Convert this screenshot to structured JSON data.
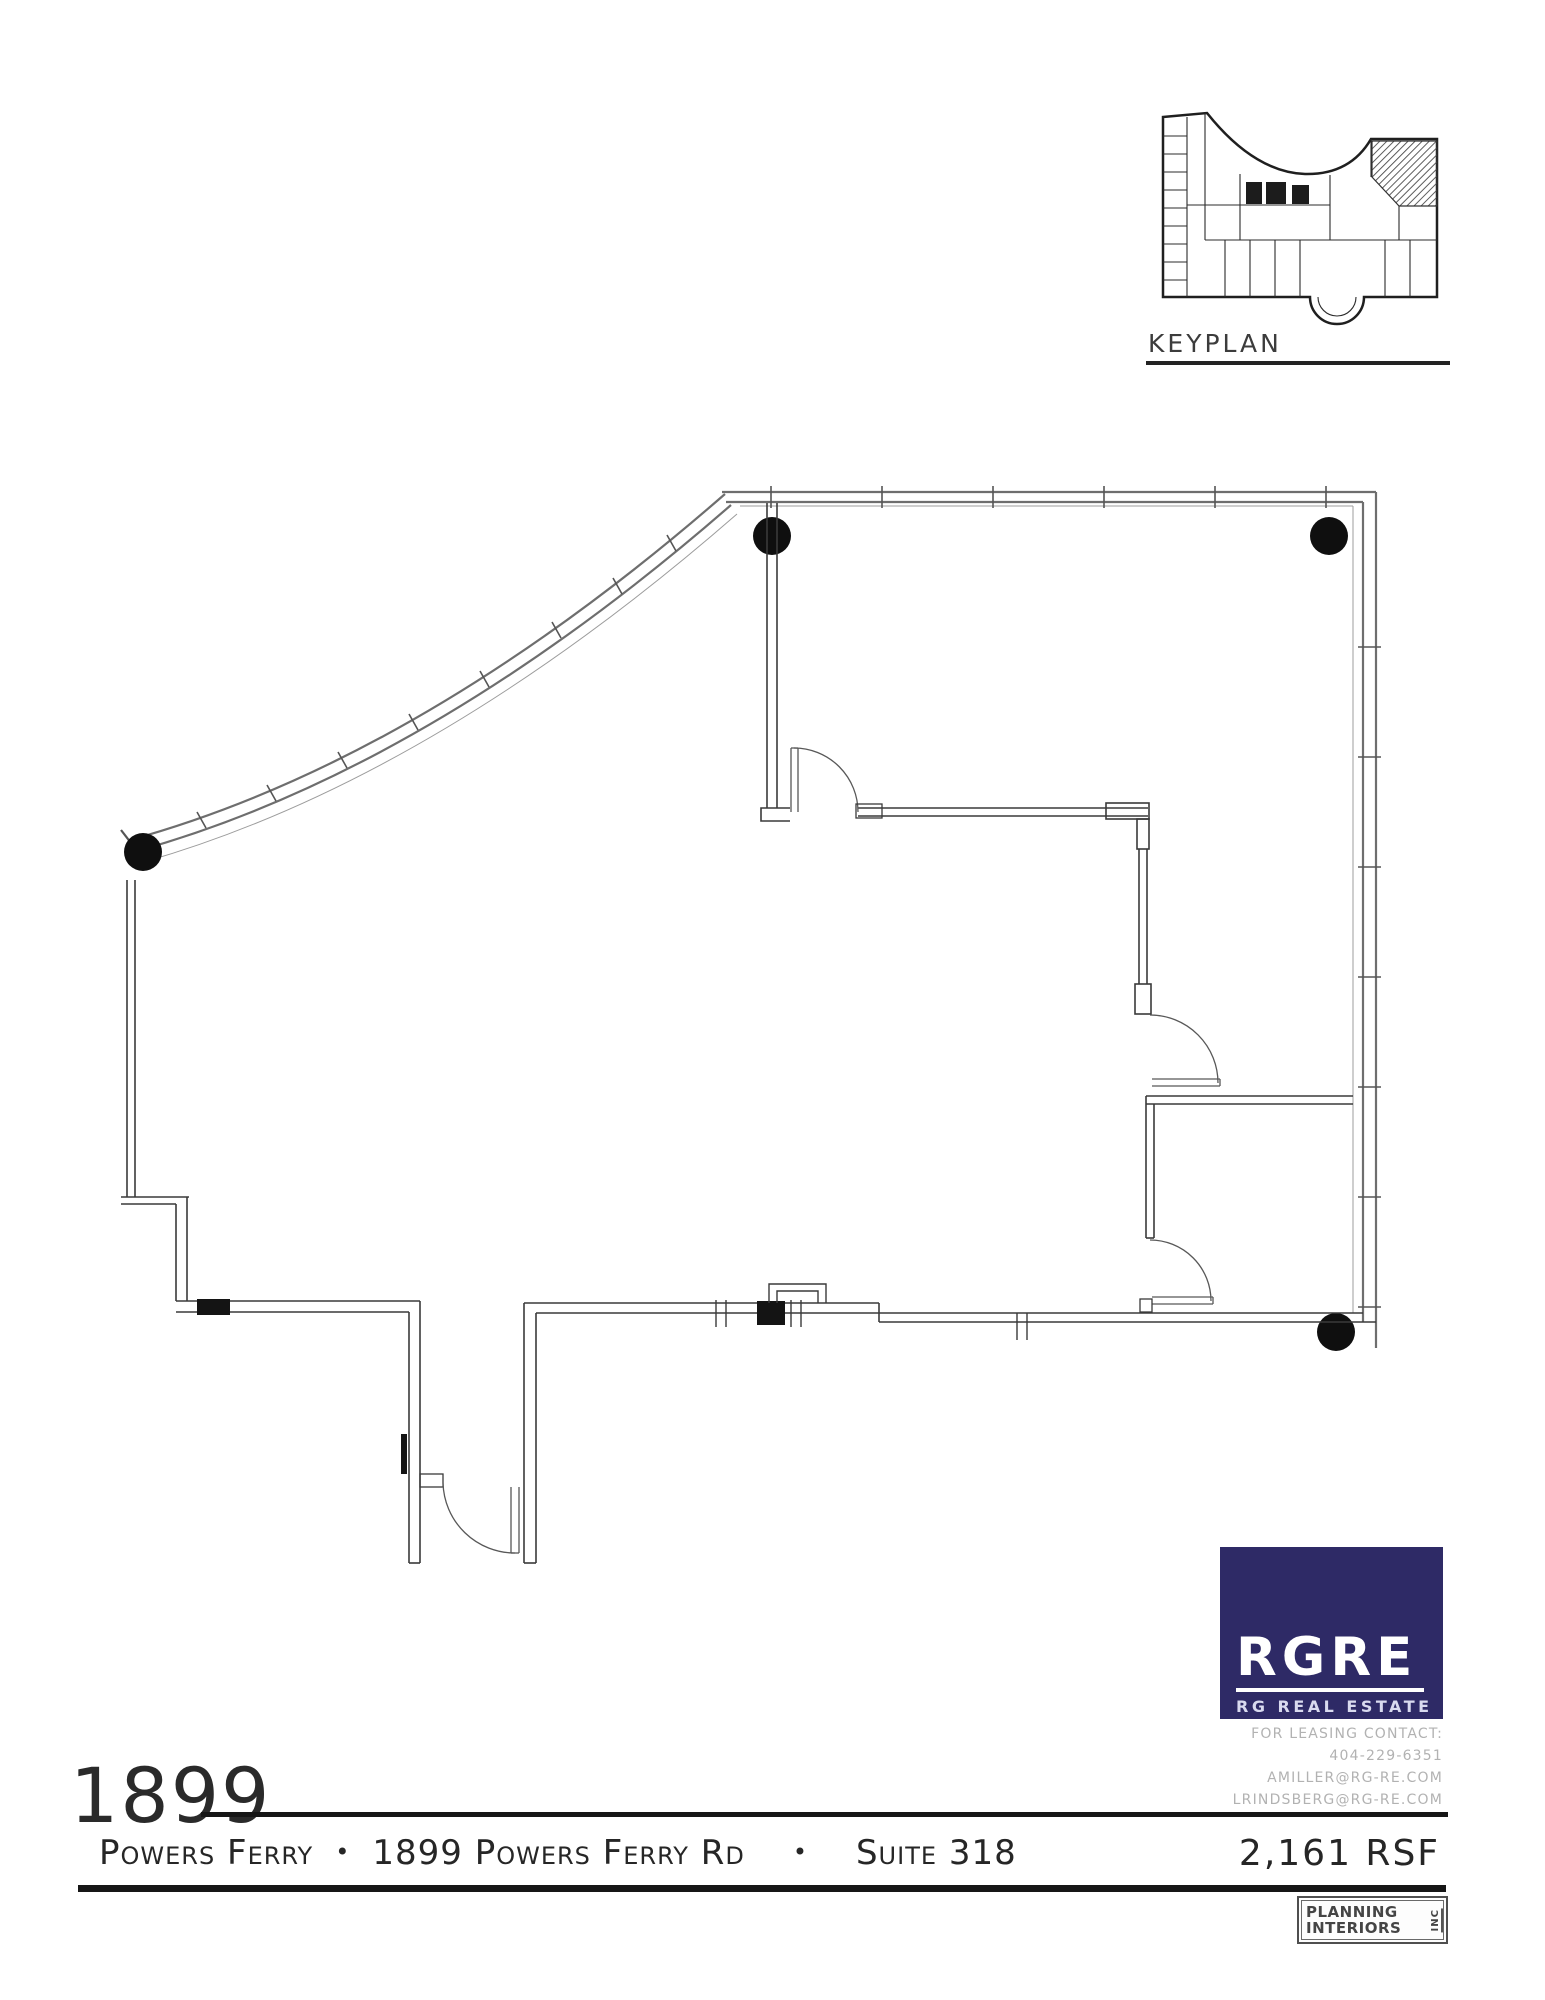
{
  "keyplan": {
    "label": "KEYPLAN"
  },
  "logo": {
    "brand": "RGRE",
    "tagline": "RG REAL ESTATE",
    "background": "#2e2a66",
    "text_color": "#ffffff"
  },
  "contact": {
    "lines": [
      "FOR LEASING CONTACT:",
      "404-229-6351",
      "AMILLER@RG-RE.COM",
      "LRINDSBERG@RG-RE.COM"
    ],
    "color": "#b2b2b2"
  },
  "footer": {
    "building_number": "1899",
    "building_name": "Powers Ferry",
    "separator": "•",
    "address": "1899 Powers Ferry Rd",
    "suite": "Suite 318",
    "area": "2,161 RSF"
  },
  "stamp": {
    "line1": "PLANNING",
    "line2": "INTERIORS",
    "suffix": "INC"
  },
  "colors": {
    "ink": "#1a1a1a",
    "exterior_wall_gray": "#6e6e6e",
    "interior_wall": "#3a3a3a",
    "column_fill": "#0f0f0f",
    "logo_navy": "#2e2a66",
    "contact_gray": "#b2b2b2"
  }
}
